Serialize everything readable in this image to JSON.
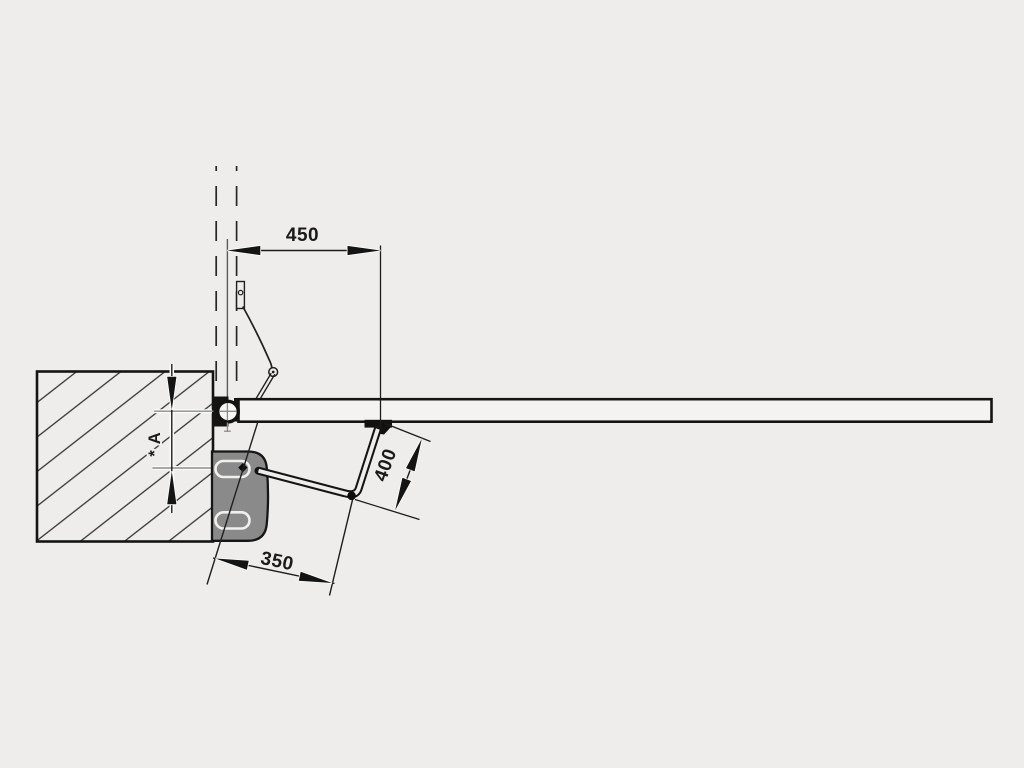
{
  "diagram": {
    "title": "swing-gate-operator-installation-top-view",
    "dimensions": {
      "horizontal_top": "450",
      "arm_diagonal": "400",
      "bottom_offset": "350",
      "pillar_vertical": "* A"
    },
    "colors": {
      "background": "#eeedec",
      "line": "#1c1c1c",
      "operator_body": "#8a8a8a",
      "centerline_gray": "#8d8d8d",
      "gate_leaf_fill": "#f4f3f1"
    }
  }
}
